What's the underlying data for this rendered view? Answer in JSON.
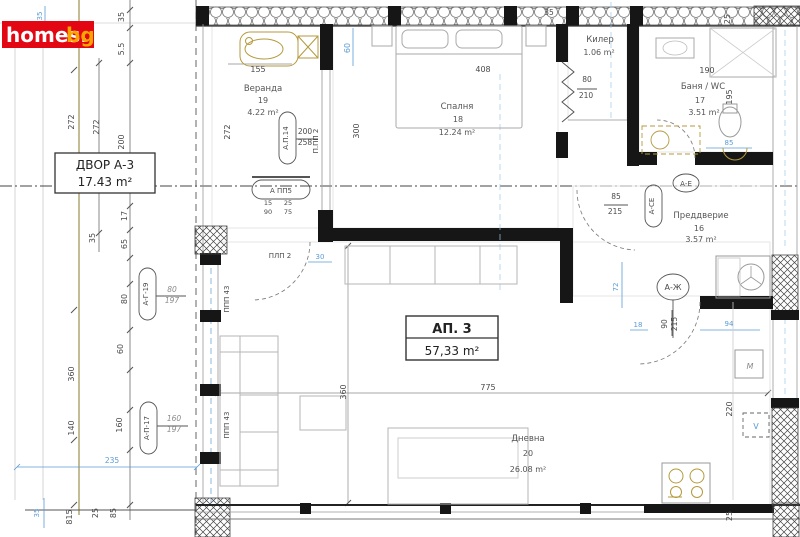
{
  "logo": {
    "main": "homes.",
    "suffix": "bg"
  },
  "plot_label": {
    "title": "ДВОР А-3",
    "area": "17.43 m²"
  },
  "apartment_label": {
    "title": "АП. 3",
    "area": "57,33 m²"
  },
  "rooms": {
    "veranda": {
      "name": "Веранда",
      "number": "19",
      "area": "4.22 m²"
    },
    "bedroom": {
      "name": "Спалня",
      "number": "18",
      "area": "12.24 m²"
    },
    "closet": {
      "name": "Килер",
      "area": "1.06 m²"
    },
    "bathroom": {
      "name": "Баня / WC",
      "number": "17",
      "area": "3.51 m²"
    },
    "vestibule": {
      "name": "Преддверие",
      "number": "16",
      "area": "3.57 m²"
    },
    "living": {
      "name": "Дневна",
      "number": "20",
      "area": "26.08 m²"
    }
  },
  "colors": {
    "logo_red": "#e30613",
    "logo_accent": "#f7a600",
    "dimension_blue": "#5b9bd5",
    "fixture_olive": "#b49a3c",
    "wall_black": "#161616"
  },
  "annotations": [
    {
      "t": "272",
      "x": 74,
      "y": 122,
      "r": -90
    },
    {
      "t": "272",
      "x": 99,
      "y": 127,
      "r": -90
    },
    {
      "t": "200",
      "x": 124,
      "y": 142,
      "r": -90
    },
    {
      "t": "5.5",
      "x": 124,
      "y": 49,
      "r": -90
    },
    {
      "t": "35",
      "x": 124,
      "y": 17,
      "r": -90
    },
    {
      "t": "35",
      "x": 95,
      "y": 238,
      "r": -90
    },
    {
      "t": "17",
      "x": 127,
      "y": 216,
      "r": -90
    },
    {
      "t": "65",
      "x": 127,
      "y": 244,
      "r": -90
    },
    {
      "t": "80",
      "x": 127,
      "y": 299,
      "r": -90
    },
    {
      "t": "60",
      "x": 123,
      "y": 349,
      "r": -90
    },
    {
      "t": "360",
      "x": 74,
      "y": 374,
      "r": -90
    },
    {
      "t": "140",
      "x": 74,
      "y": 428,
      "r": -90
    },
    {
      "t": "160",
      "x": 122,
      "y": 425,
      "r": -90
    },
    {
      "t": "815",
      "x": 72,
      "y": 517,
      "r": -90
    },
    {
      "t": "25",
      "x": 98,
      "y": 513,
      "r": -90
    },
    {
      "t": "85",
      "x": 116,
      "y": 513,
      "r": -90
    },
    {
      "t": "272",
      "x": 230,
      "y": 132,
      "r": -90
    },
    {
      "t": "155",
      "x": 258,
      "y": 72
    },
    {
      "t": "408",
      "x": 483,
      "y": 72
    },
    {
      "t": "300",
      "x": 359,
      "y": 131,
      "r": -90
    },
    {
      "t": "200",
      "x": 305,
      "y": 134,
      "s": 7.5
    },
    {
      "t": "258",
      "x": 305,
      "y": 145,
      "s": 7.5
    },
    {
      "t": "80",
      "x": 172,
      "y": 292,
      "s": 7.5,
      "c": "g"
    },
    {
      "t": "197",
      "x": 172,
      "y": 303,
      "s": 7.5,
      "c": "g"
    },
    {
      "t": "160",
      "x": 174,
      "y": 421,
      "s": 7.5,
      "c": "g"
    },
    {
      "t": "197",
      "x": 174,
      "y": 432,
      "s": 7.5,
      "c": "g"
    },
    {
      "t": "80",
      "x": 587,
      "y": 82,
      "s": 7.5
    },
    {
      "t": "210",
      "x": 586,
      "y": 98,
      "s": 7.5
    },
    {
      "t": "85",
      "x": 616,
      "y": 199,
      "s": 7.5
    },
    {
      "t": "215",
      "x": 615,
      "y": 214,
      "s": 7.5
    },
    {
      "t": "90",
      "x": 667,
      "y": 324,
      "r": -90,
      "s": 7.5
    },
    {
      "t": "215",
      "x": 677,
      "y": 324,
      "r": -90,
      "s": 7.5
    },
    {
      "t": "190",
      "x": 707,
      "y": 73
    },
    {
      "t": "195",
      "x": 732,
      "y": 97,
      "r": -90
    },
    {
      "t": "25",
      "x": 730,
      "y": 19,
      "r": -90
    },
    {
      "t": "35",
      "x": 549,
      "y": 15,
      "s": 7.5
    },
    {
      "t": "775",
      "x": 488,
      "y": 390
    },
    {
      "t": "360",
      "x": 346,
      "y": 392,
      "r": -90
    },
    {
      "t": "220",
      "x": 732,
      "y": 409,
      "r": -90
    },
    {
      "t": "25",
      "x": 732,
      "y": 516,
      "r": -90
    },
    {
      "t": "15",
      "x": 268,
      "y": 205,
      "s": 6.5
    },
    {
      "t": "90",
      "x": 268,
      "y": 214,
      "s": 6.5
    },
    {
      "t": "25",
      "x": 288,
      "y": 205,
      "s": 6.5
    },
    {
      "t": "75",
      "x": 288,
      "y": 214,
      "s": 6.5
    },
    {
      "t": "А.П.14",
      "x": 288,
      "y": 138,
      "r": -90,
      "s": 7,
      "n": "window-tag"
    },
    {
      "t": "А ПП5",
      "x": 281,
      "y": 193,
      "s": 7,
      "n": "window-tag"
    },
    {
      "t": "А-Г-19",
      "x": 148,
      "y": 294,
      "r": -90,
      "s": 7,
      "n": "window-tag"
    },
    {
      "t": "А-П-17",
      "x": 149,
      "y": 428,
      "r": -90,
      "s": 7,
      "n": "window-tag"
    },
    {
      "t": "А-СЕ",
      "x": 654,
      "y": 206,
      "r": -90,
      "s": 7,
      "n": "door-tag"
    },
    {
      "t": "А-Ж",
      "x": 673,
      "y": 290,
      "s": 8,
      "n": "door-tag"
    },
    {
      "t": "А-Е",
      "x": 686,
      "y": 186,
      "s": 7,
      "n": "axis-tag"
    },
    {
      "t": "П.ПП 2",
      "x": 318,
      "y": 141,
      "r": -90,
      "s": 7,
      "n": "window-tag"
    },
    {
      "t": "ППП 43",
      "x": 229,
      "y": 299,
      "r": -90,
      "s": 7,
      "n": "window-tag"
    },
    {
      "t": "ППП 43",
      "x": 229,
      "y": 425,
      "r": -90,
      "s": 7,
      "n": "window-tag"
    },
    {
      "t": "ПЛП 2",
      "x": 280,
      "y": 258,
      "s": 7,
      "n": "door-tag"
    },
    {
      "t": "М",
      "x": 750,
      "y": 369,
      "s": 8,
      "c": "g",
      "n": "appliance-label"
    },
    {
      "t": "V",
      "x": 756,
      "y": 429,
      "s": 8,
      "c": "b",
      "n": "appliance-label"
    },
    {
      "t": "60",
      "x": 350,
      "y": 48,
      "r": -90,
      "c": "b"
    },
    {
      "t": "35",
      "x": 42,
      "y": 16,
      "r": -90,
      "s": 7,
      "c": "b"
    },
    {
      "t": "30",
      "x": 320,
      "y": 259,
      "s": 7,
      "c": "b"
    },
    {
      "t": "72",
      "x": 618,
      "y": 287,
      "r": -90,
      "s": 7,
      "c": "b"
    },
    {
      "t": "85",
      "x": 729,
      "y": 145,
      "s": 7,
      "c": "b"
    },
    {
      "t": "94",
      "x": 729,
      "y": 326,
      "s": 7,
      "c": "b"
    },
    {
      "t": "18",
      "x": 638,
      "y": 327,
      "s": 7,
      "c": "b"
    },
    {
      "t": "235",
      "x": 112,
      "y": 463,
      "s": 7.5,
      "c": "b"
    },
    {
      "t": "35",
      "x": 39,
      "y": 513,
      "r": -90,
      "s": 7,
      "c": "b"
    }
  ]
}
